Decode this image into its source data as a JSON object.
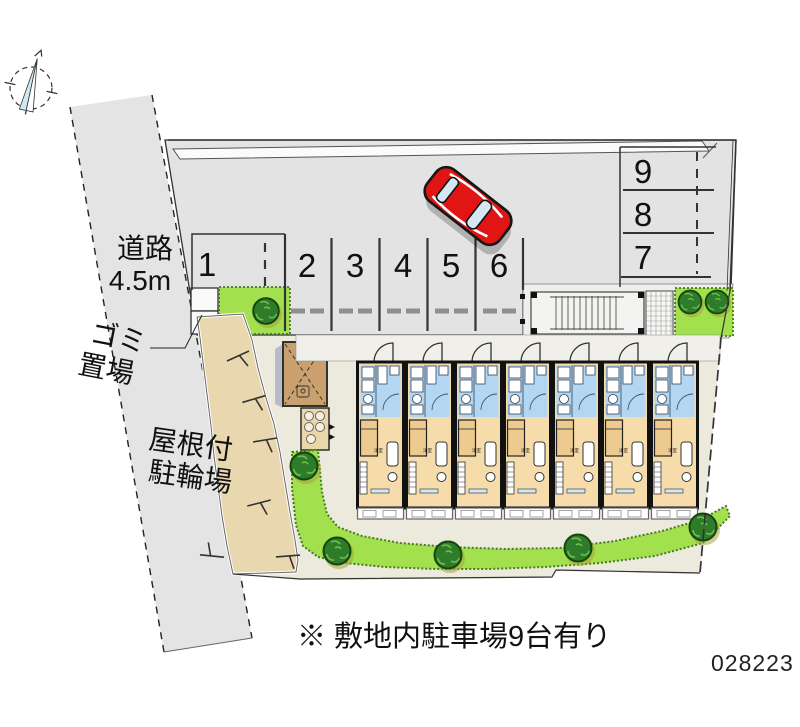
{
  "document": {
    "note": "※ 敷地内駐車場9台有り",
    "plan_number": "028223"
  },
  "road": {
    "name": "道路",
    "width": "4.5m"
  },
  "facilities": {
    "garbage": {
      "line1": "ゴミ",
      "line2": "置場"
    },
    "bicycle": {
      "line1": "屋根付",
      "line2": "駐輪場"
    }
  },
  "parking": {
    "stalls": [
      "1",
      "2",
      "3",
      "4",
      "5",
      "6",
      "7",
      "8",
      "9"
    ]
  },
  "building": {
    "units": 7,
    "room_label": "洋室"
  },
  "colors": {
    "asphalt": "#e3e3e3",
    "lawn": "#a2e14d",
    "bush": "#2e7c2a",
    "car": "#e21515",
    "unit_blue": "#b3d6f2",
    "unit_tan": "#f6dcab",
    "path_tan": "#e9d8af"
  }
}
